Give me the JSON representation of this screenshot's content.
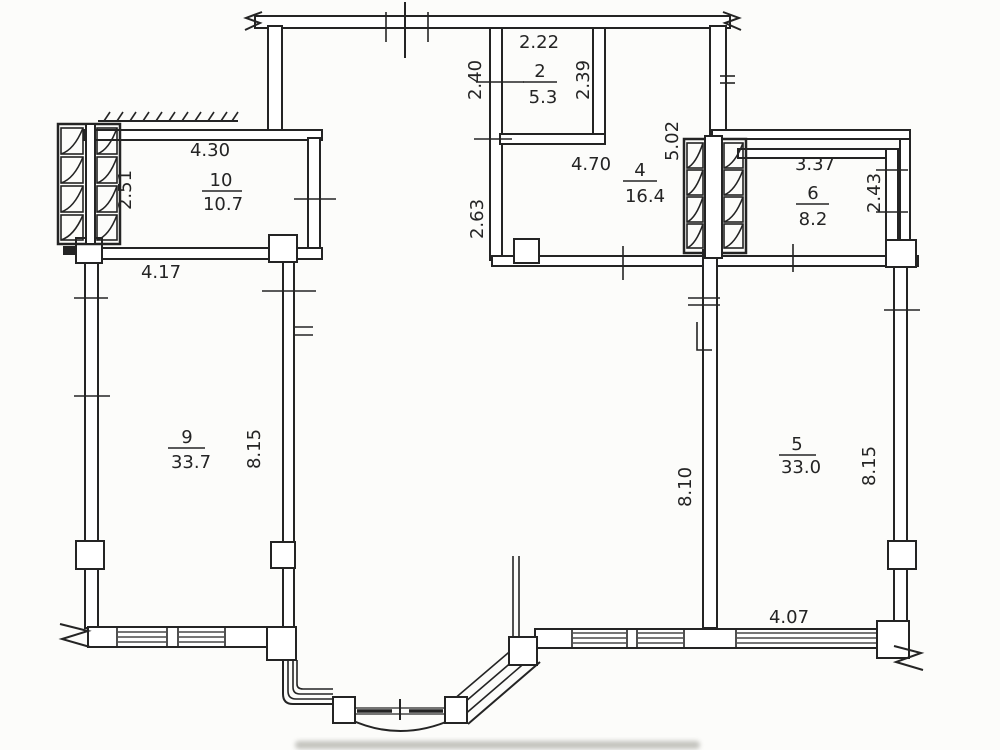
{
  "document": {
    "type": "apartment floor plan (scanned drawing)"
  },
  "colors": {
    "ink": "#242424",
    "paper": "#fcfcfa",
    "smudge": "#94948c"
  },
  "rooms": {
    "r2": {
      "number": "2",
      "area": "5.3"
    },
    "r4": {
      "number": "4",
      "area": "16.4"
    },
    "r5": {
      "number": "5",
      "area": "33.0"
    },
    "r6": {
      "number": "6",
      "area": "8.2"
    },
    "r9": {
      "number": "9",
      "area": "33.7"
    },
    "r10": {
      "number": "10",
      "area": "10.7"
    }
  },
  "dimensions": {
    "room2_width_top": "2.22",
    "room2_height_left": "2.40",
    "room2_height_right": "2.39",
    "room10_width_top": "4.30",
    "room10_height_left": "2.51",
    "room10_width_bottom": "4.17",
    "room4_width_top": "4.70",
    "room4_height_left": "2.63",
    "room4_height_right": "5.02",
    "room6_width_top": "3.37",
    "room6_height_right": "2.43",
    "room9_height": "8.15",
    "room5_height_left": "8.10",
    "room5_height_right": "8.15",
    "room5_width_bottom": "4.07"
  }
}
